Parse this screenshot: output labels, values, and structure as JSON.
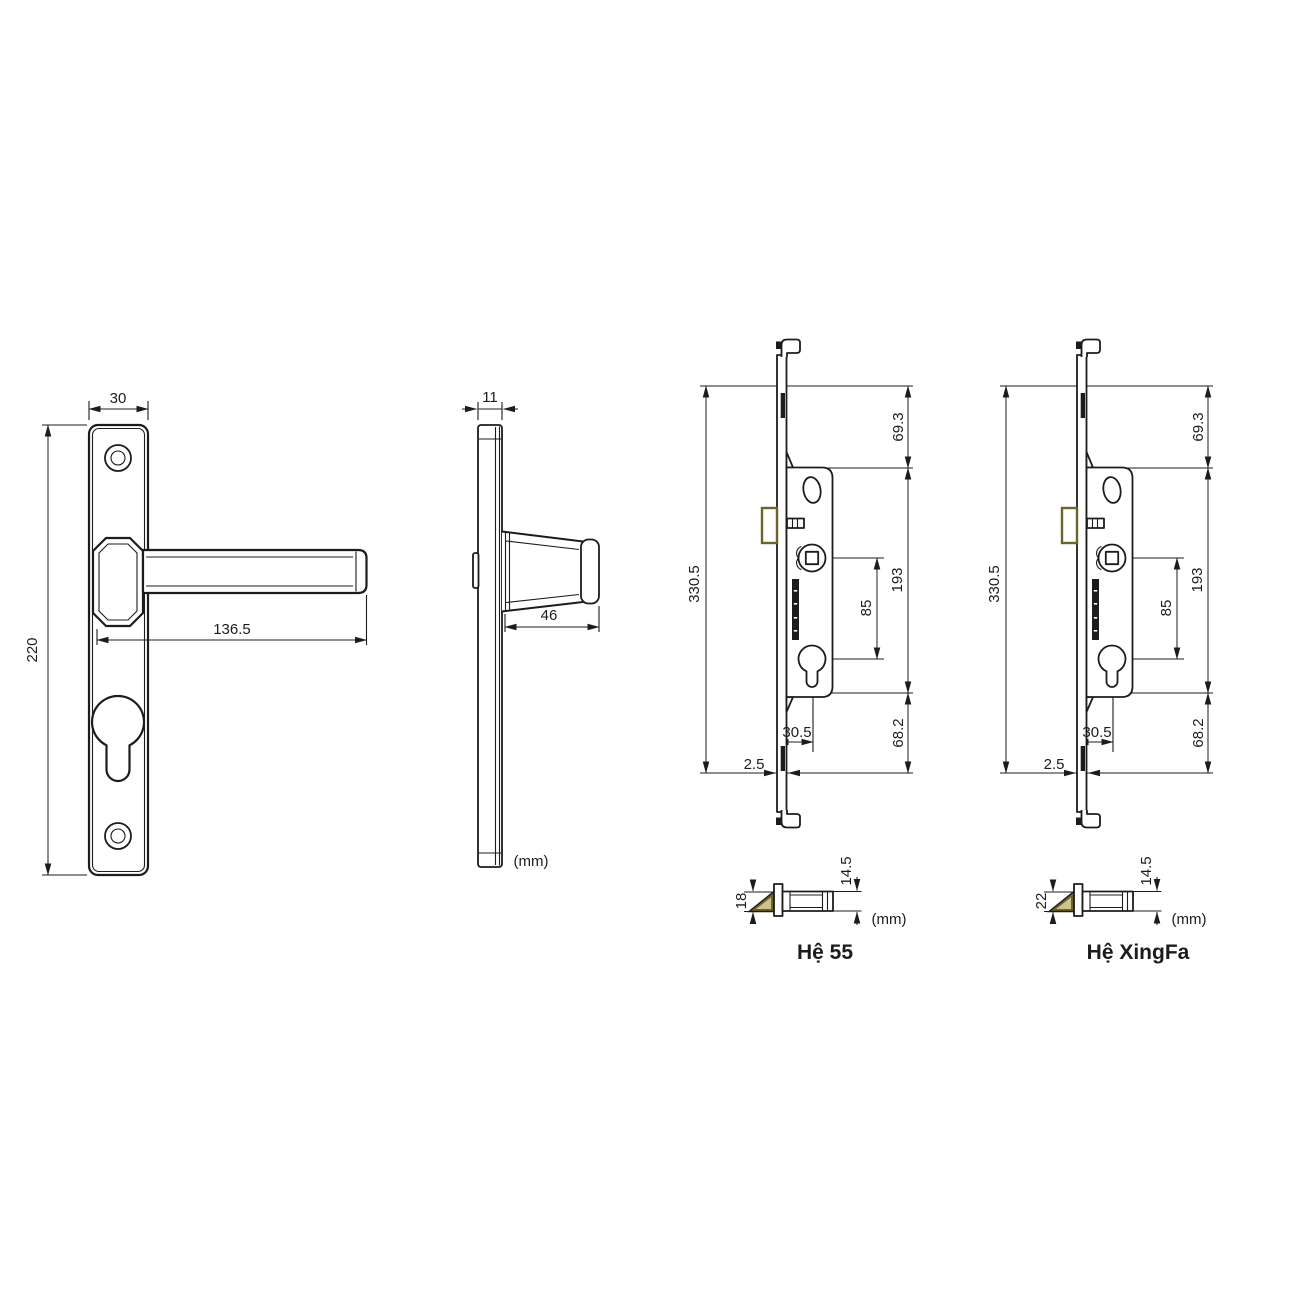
{
  "front_view": {
    "plate_width_mm": "30",
    "plate_height_mm": "220",
    "handle_length_mm": "136.5"
  },
  "side_view": {
    "plate_thickness_mm": "11",
    "handle_depth_mm": "46",
    "unit_label": "(mm)"
  },
  "locks": [
    {
      "name": "Hệ 55",
      "total_height_mm": "330.5",
      "top_section_mm": "69.3",
      "body_section_mm": "193",
      "spindle_to_cylinder_mm": "85",
      "bottom_section_mm": "68.2",
      "backset_mm": "30.5",
      "faceplate_thickness_mm": "2.5",
      "latch_height_mm": "18",
      "latch_body_height_mm": "14.5",
      "unit_label": "(mm)"
    },
    {
      "name": "Hệ XingFa",
      "total_height_mm": "330.5",
      "top_section_mm": "69.3",
      "body_section_mm": "193",
      "spindle_to_cylinder_mm": "85",
      "bottom_section_mm": "68.2",
      "backset_mm": "30.5",
      "faceplate_thickness_mm": "2.5",
      "latch_height_mm": "22",
      "latch_body_height_mm": "14.5",
      "unit_label": "(mm)"
    }
  ],
  "colors": {
    "line": "#1c1c1c",
    "latch": "#6d6527",
    "latch_inner": "#cfc38a",
    "background": "#ffffff"
  }
}
